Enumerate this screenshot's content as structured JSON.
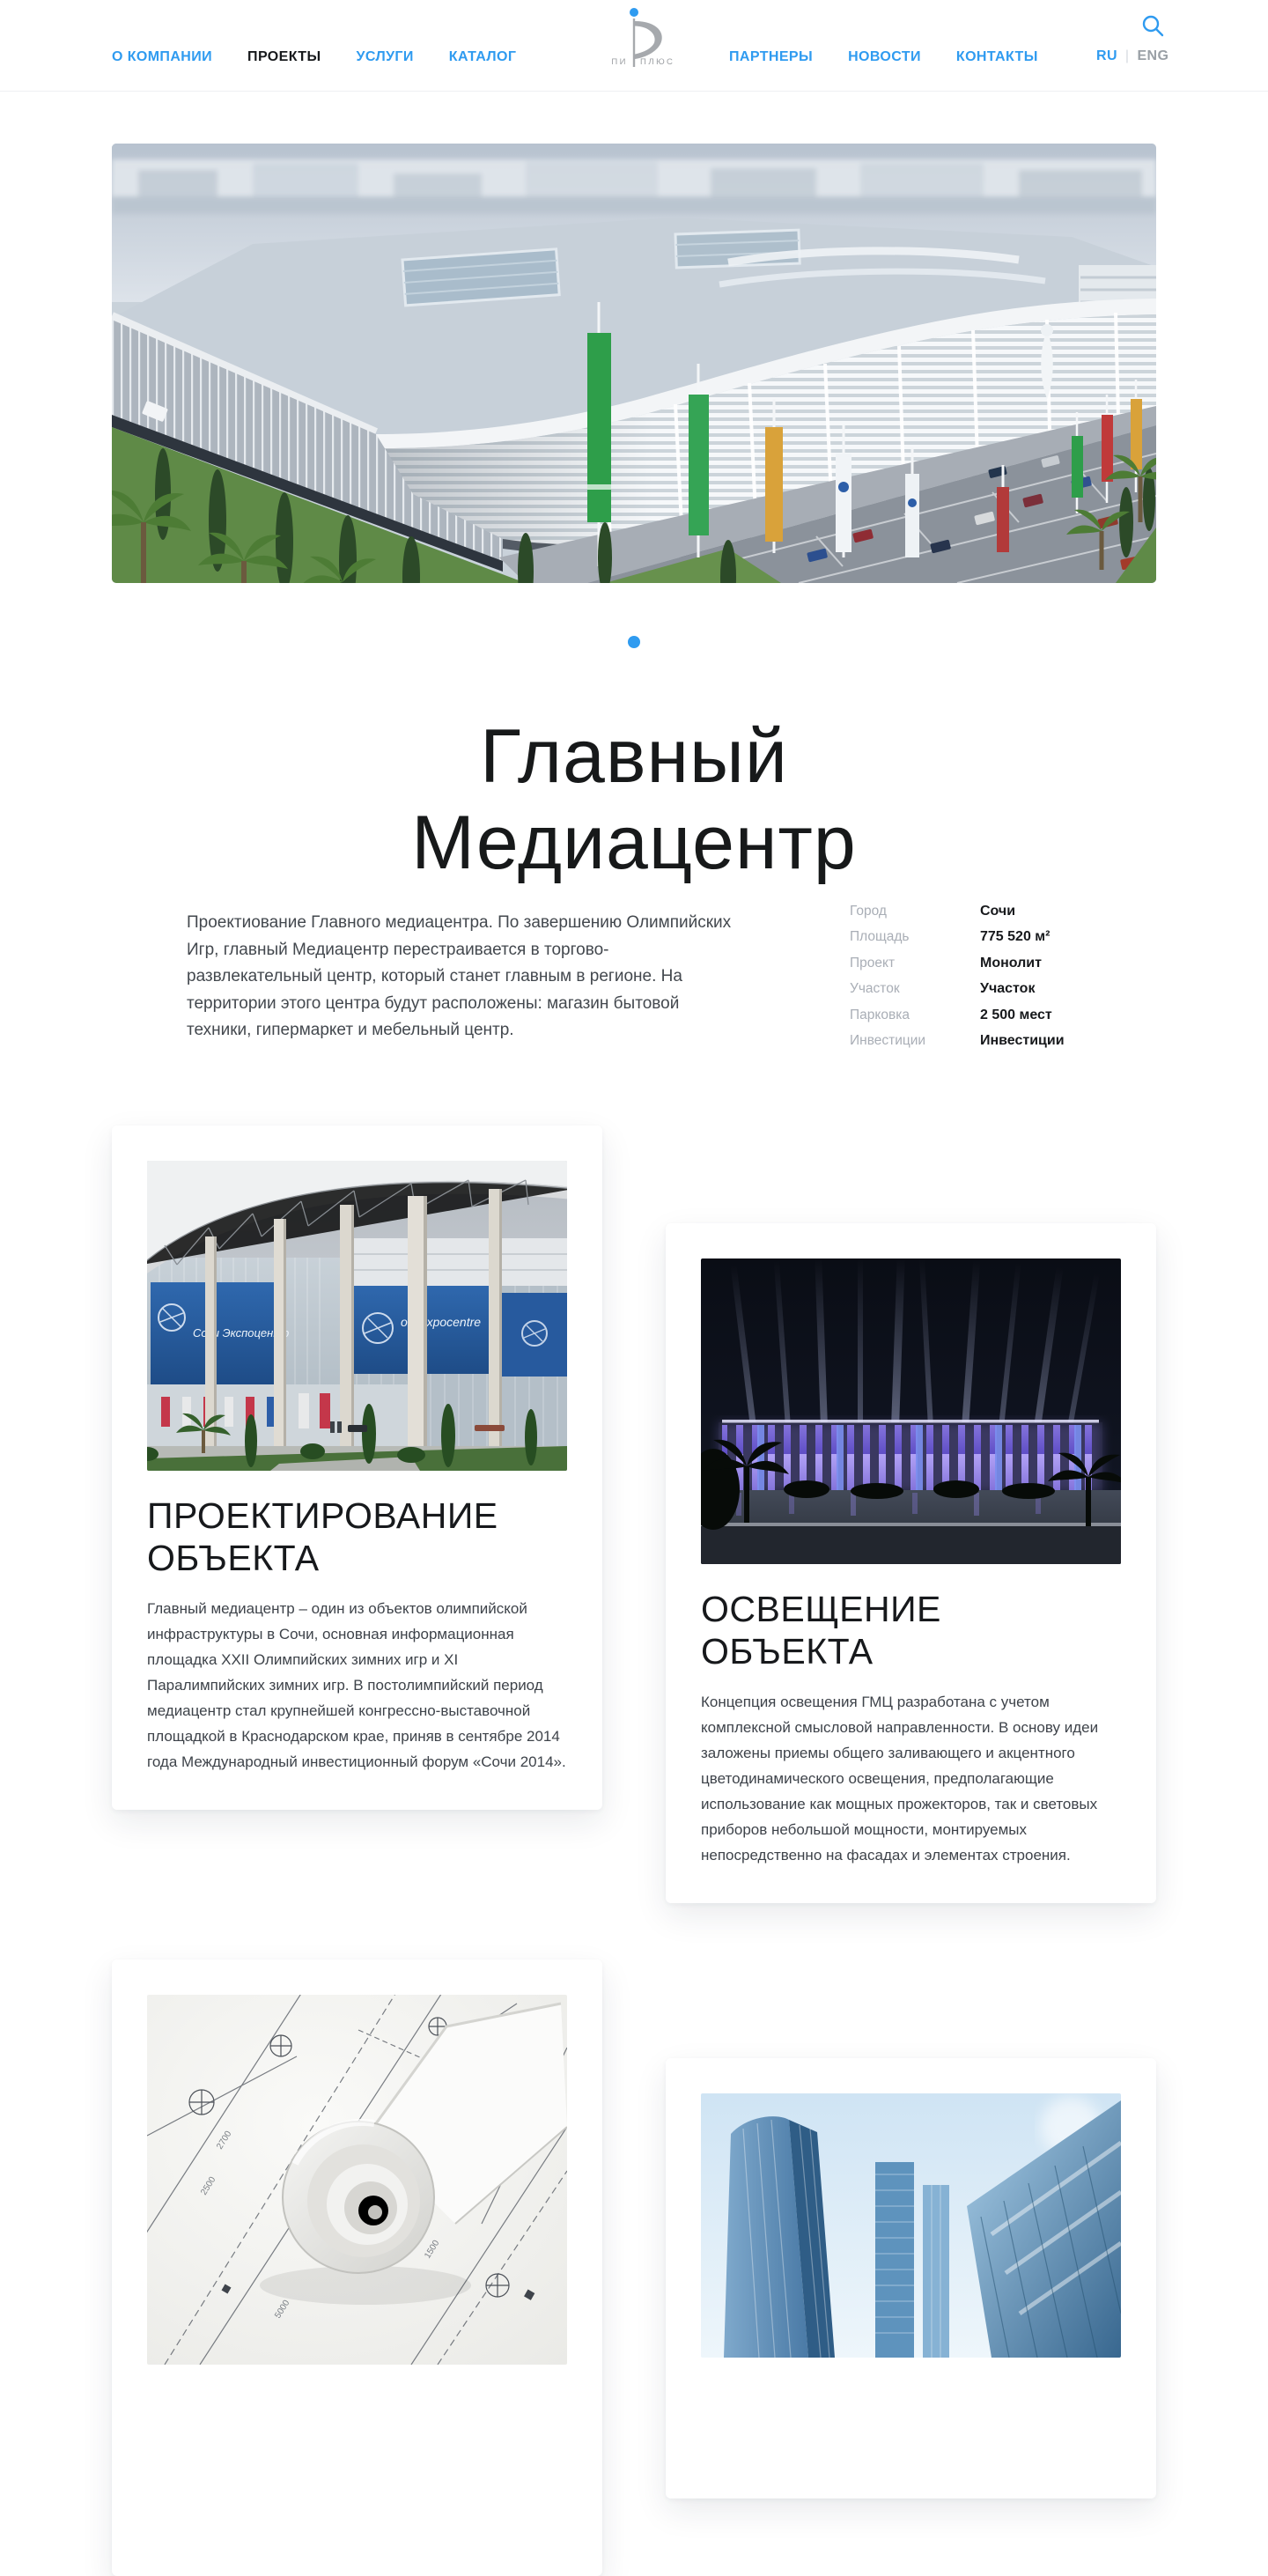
{
  "nav": {
    "left": [
      {
        "label": "О КОМПАНИИ",
        "active": false
      },
      {
        "label": "ПРОЕКТЫ",
        "active": true
      },
      {
        "label": "УСЛУГИ",
        "active": false
      },
      {
        "label": "КАТАЛОГ",
        "active": false
      }
    ],
    "right": [
      {
        "label": "ПАРТНЕРЫ"
      },
      {
        "label": "НОВОСТИ"
      },
      {
        "label": "КОНТАКТЫ"
      }
    ],
    "logo": {
      "left": "ПИ",
      "right": "ПЛЮС"
    },
    "lang": {
      "current": "RU",
      "divider": "|",
      "other": "ENG"
    }
  },
  "project": {
    "title": "Главный Медиацентр",
    "description": "Проектиование Главного медиацентра. По завершению Олимпийских Игр, главный Медиацентр перестраивается в торгово-развлекательный центр, который станет главным в регионе. На территории этого центра будут расположены: магазин бытовой техники, гипермаркет и мебельный центр.",
    "facts": [
      {
        "label": "Город",
        "value": "Сочи"
      },
      {
        "label": "Площадь",
        "value": "775 520 м²"
      },
      {
        "label": "Проект",
        "value": "Монолит"
      },
      {
        "label": "Участок",
        "value": "Участок"
      },
      {
        "label": "Парковка",
        "value": "2 500 мест"
      },
      {
        "label": "Инвестиции",
        "value": "Инвестиции"
      }
    ]
  },
  "cards": [
    {
      "title": "ПРОЕКТИРОВАНИЕ ОБЪЕКТА",
      "body": "Главный медиацентр – один из объектов олимпийской инфраструктуры в Сочи, основная информационная площадка XXII Олимпийских зимних игр и XI Паралимпийских зимних игр. В постолимпийский период медиацентр стал крупнейшей конгрессно-выставочной площадкой в Краснодарском крае, приняв в сентябре 2014 года Международный инвестиционный форум «Сочи 2014»."
    },
    {
      "title": "ОСВЕЩЕНИЕ ОБЪЕКТА",
      "body": "Концепция освещения ГМЦ разработана с учетом комплексной смысловой направленности. В основу идеи заложены приемы общего заливающего и акцентного цветодинамического освещения, предполагающие использование как мощных прожекторов, так и световых приборов небольшой мощности, монтируемых непосредственно на фасадах и элементах строения."
    }
  ],
  "images": {
    "expocentre": {
      "sign_left": "Сочи Экспоцентр",
      "sign_right": "ochi xpocentre"
    },
    "blueprint_labels": [
      "2700",
      "2500",
      "5000",
      "1500"
    ]
  },
  "colors": {
    "accent": "#2F9BF0",
    "active_link": "#17191C",
    "muted_label": "#A9AEB6",
    "lang_inactive": "#9AA0A6"
  }
}
